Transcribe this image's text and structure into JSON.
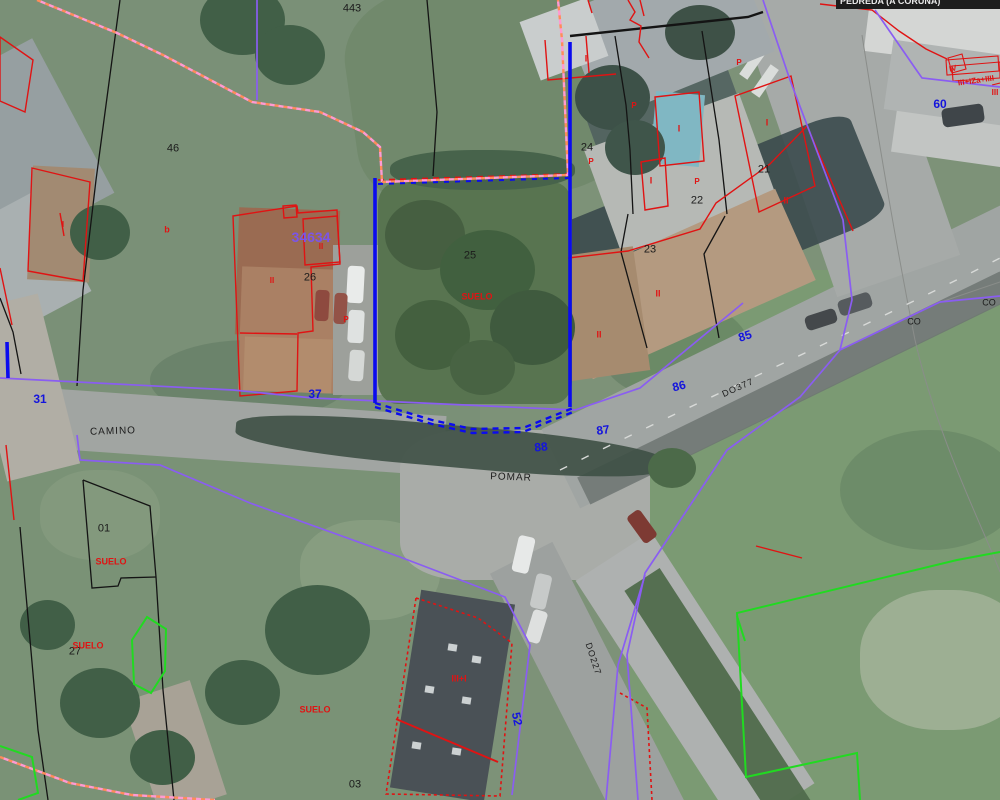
{
  "viewer": {
    "tooltip": "PEDREDA (A CORUÑA)",
    "colors": {
      "parcel_line_black": "#141414",
      "building_line_red": "#e01313",
      "road_number_blue": "#1414dd",
      "boundary_purple": "#8a5df2",
      "municipal_dash_pink": "#ff9d92",
      "municipal_dash_orange": "#ff8c5a",
      "other_boundary_green": "#21da21",
      "selected_parcel_blue": "#0b0bef",
      "reference_purple": "#7b55e8"
    },
    "labels": [
      {
        "text": "443",
        "x": 352,
        "y": 9,
        "c": "black",
        "s": 11
      },
      {
        "text": "46",
        "x": 173,
        "y": 149,
        "c": "black",
        "s": 11
      },
      {
        "text": "24",
        "x": 587,
        "y": 148,
        "c": "black",
        "s": 11
      },
      {
        "text": "25",
        "x": 470,
        "y": 256,
        "c": "black",
        "s": 11
      },
      {
        "text": "26",
        "x": 310,
        "y": 278,
        "c": "black",
        "s": 11
      },
      {
        "text": "23",
        "x": 650,
        "y": 250,
        "c": "black",
        "s": 11
      },
      {
        "text": "22",
        "x": 697,
        "y": 201,
        "c": "black",
        "s": 11
      },
      {
        "text": "21",
        "x": 764,
        "y": 170,
        "c": "black",
        "s": 11
      },
      {
        "text": "01",
        "x": 104,
        "y": 529,
        "c": "black",
        "s": 11
      },
      {
        "text": "27",
        "x": 75,
        "y": 652,
        "c": "black",
        "s": 11
      },
      {
        "text": "03",
        "x": 355,
        "y": 785,
        "c": "black",
        "s": 11
      },
      {
        "text": "CO",
        "x": 914,
        "y": 322,
        "c": "black",
        "s": 9
      },
      {
        "text": "CO",
        "x": 989,
        "y": 303,
        "c": "black",
        "s": 9
      },
      {
        "text": "CAMINO",
        "x": 113,
        "y": 432,
        "c": "black",
        "s": 10,
        "r": -2,
        "ls": 1
      },
      {
        "text": "POMAR",
        "x": 511,
        "y": 478,
        "c": "black",
        "s": 10,
        "r": 2,
        "ls": 1
      },
      {
        "text": "DO377",
        "x": 738,
        "y": 388,
        "c": "black",
        "s": 9,
        "r": -24,
        "ls": 1
      },
      {
        "text": "DO227",
        "x": 593,
        "y": 659,
        "c": "black",
        "s": 9,
        "r": 72,
        "ls": 1
      },
      {
        "text": "31",
        "x": 40,
        "y": 399,
        "c": "blue",
        "s": 12
      },
      {
        "text": "37",
        "x": 315,
        "y": 394,
        "c": "blue",
        "s": 12
      },
      {
        "text": "88",
        "x": 541,
        "y": 447,
        "c": "blue",
        "s": 12,
        "r": -6
      },
      {
        "text": "87",
        "x": 603,
        "y": 430,
        "c": "blue",
        "s": 12,
        "r": -8
      },
      {
        "text": "86",
        "x": 679,
        "y": 386,
        "c": "blue",
        "s": 12,
        "r": -14
      },
      {
        "text": "85",
        "x": 745,
        "y": 336,
        "c": "blue",
        "s": 12,
        "r": -18
      },
      {
        "text": "60",
        "x": 940,
        "y": 104,
        "c": "blue",
        "s": 12
      },
      {
        "text": "52",
        "x": 517,
        "y": 719,
        "c": "blue",
        "s": 12,
        "r": 78
      },
      {
        "text": "34634",
        "x": 311,
        "y": 237,
        "c": "purple",
        "s": 14
      },
      {
        "text": "SUELO",
        "x": 477,
        "y": 297,
        "c": "red",
        "s": 9
      },
      {
        "text": "SUELO",
        "x": 111,
        "y": 562,
        "c": "red",
        "s": 9
      },
      {
        "text": "SUELO",
        "x": 88,
        "y": 646,
        "c": "red",
        "s": 9
      },
      {
        "text": "SUELO",
        "x": 315,
        "y": 710,
        "c": "red",
        "s": 9
      },
      {
        "text": "b",
        "x": 167,
        "y": 230,
        "c": "red",
        "s": 9
      },
      {
        "text": "I",
        "x": 63,
        "y": 225,
        "c": "red",
        "s": 8
      },
      {
        "text": "I",
        "x": 586,
        "y": 59,
        "c": "red",
        "s": 9
      },
      {
        "text": "I",
        "x": 679,
        "y": 129,
        "c": "red",
        "s": 9
      },
      {
        "text": "I",
        "x": 767,
        "y": 123,
        "c": "red",
        "s": 9
      },
      {
        "text": "I",
        "x": 651,
        "y": 181,
        "c": "red",
        "s": 9
      },
      {
        "text": "P",
        "x": 591,
        "y": 162,
        "c": "red",
        "s": 8
      },
      {
        "text": "P",
        "x": 634,
        "y": 106,
        "c": "red",
        "s": 8
      },
      {
        "text": "P",
        "x": 739,
        "y": 63,
        "c": "red",
        "s": 8
      },
      {
        "text": "P",
        "x": 697,
        "y": 182,
        "c": "red",
        "s": 8
      },
      {
        "text": "P",
        "x": 346,
        "y": 320,
        "c": "red",
        "s": 8
      },
      {
        "text": "II",
        "x": 786,
        "y": 201,
        "c": "red",
        "s": 9
      },
      {
        "text": "II",
        "x": 658,
        "y": 294,
        "c": "red",
        "s": 9
      },
      {
        "text": "II",
        "x": 599,
        "y": 335,
        "c": "red",
        "s": 9
      },
      {
        "text": "II",
        "x": 321,
        "y": 247,
        "c": "red",
        "s": 8
      },
      {
        "text": "II",
        "x": 272,
        "y": 281,
        "c": "red",
        "s": 8
      },
      {
        "text": "III+I",
        "x": 459,
        "y": 679,
        "c": "red",
        "s": 9
      },
      {
        "text": "IV",
        "x": 953,
        "y": 69,
        "c": "red",
        "s": 8,
        "r": -12
      },
      {
        "text": "III+IZa+IIII",
        "x": 976,
        "y": 81,
        "c": "red",
        "s": 8,
        "r": -8
      },
      {
        "text": "III",
        "x": 995,
        "y": 93,
        "c": "red",
        "s": 8
      }
    ]
  }
}
